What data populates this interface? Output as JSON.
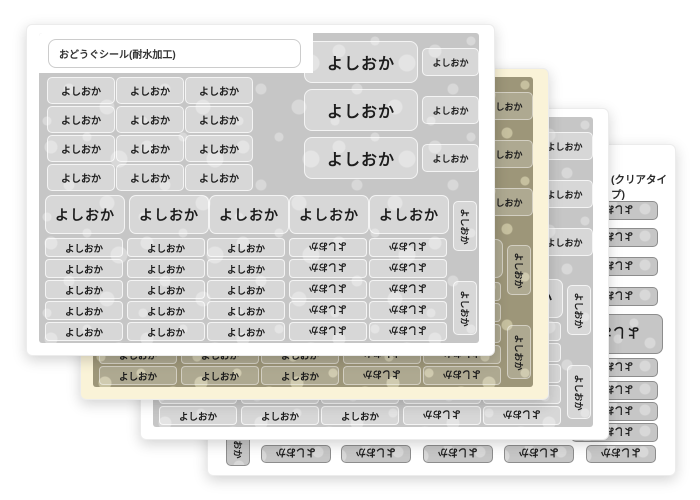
{
  "sticker_name": "よしおか",
  "sheets": {
    "sheet1_title": "おどうぐシール(耐水加工)",
    "sheet4_title": "(クリアタイプ)"
  },
  "colors": {
    "page_bg": "#ffffff",
    "card_bg": "#ffffff",
    "cream_card_bg": "#faf3d8",
    "gray_pattern_base": "#c6c6c6",
    "gray_pattern_flower": "#d8d8d8",
    "olive_pattern_base": "#9d9679",
    "olive_pattern_flower": "#c6c09f",
    "sticker_text": "#1c1c1c",
    "clear_sticker_border": "#8d8d8d"
  }
}
